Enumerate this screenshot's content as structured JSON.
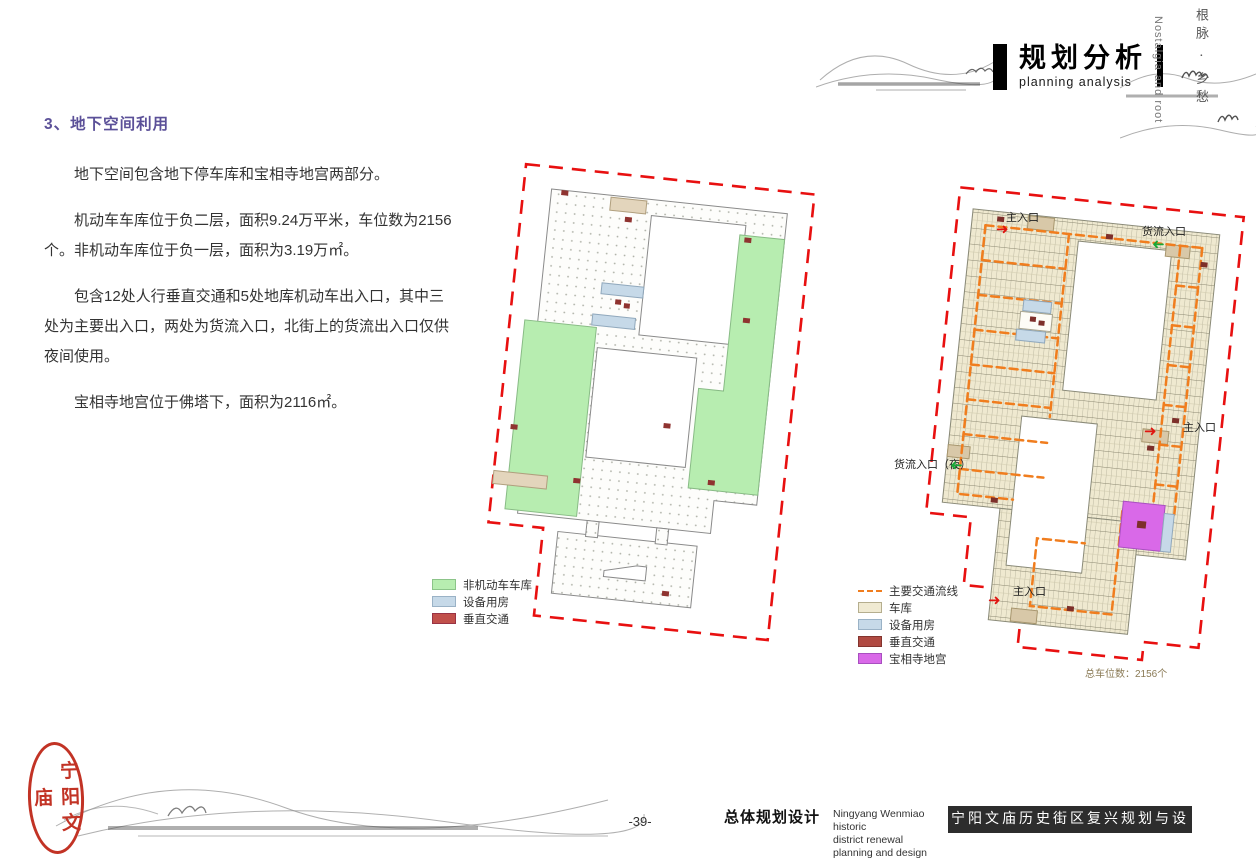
{
  "header": {
    "title_cn": "规划分析",
    "title_en": "planning analysis",
    "corner_cn": "根脉 · 乡愁",
    "corner_en": "Nostalgia and root"
  },
  "article": {
    "heading": "3、地下空间利用",
    "paragraphs": [
      "地下空间包含地下停车库和宝相寺地宫两部分。",
      "机动车车库位于负二层，面积9.24万平米，车位数为2156个。非机动车库位于负一层，面积为3.19万㎡。",
      "包含12处人行垂直交通和5处地库机动车出入口，其中三处为主要出入口，两处为货流入口，北街上的货流出入口仅供夜间使用。",
      "宝相寺地宫位于佛塔下，面积为2116㎡。"
    ]
  },
  "left_map": {
    "legend": [
      {
        "label": "非机动车车库",
        "color": "#b7edb0"
      },
      {
        "label": "设备用房",
        "color": "#c6d9e8"
      },
      {
        "label": "垂直交通",
        "color": "#c1504b"
      }
    ]
  },
  "right_map": {
    "labels": {
      "entrance_top": "主入口",
      "freight_top": "货流入口",
      "entrance_right": "主入口",
      "freight_left": "货流入口（夜）",
      "entrance_bottom": "主入口",
      "capacity_note": "总车位数：2156个"
    },
    "legend": [
      {
        "label": "主要交通流线",
        "color": "#f07d1e",
        "type": "dashed-line"
      },
      {
        "label": "车库",
        "color": "#f0ead2"
      },
      {
        "label": "设备用房",
        "color": "#c6d9e8"
      },
      {
        "label": "垂直交通",
        "color": "#b04a42"
      },
      {
        "label": "宝相寺地宫",
        "color": "#d969e8"
      }
    ]
  },
  "footer": {
    "page_number": "-39-",
    "doc_title_cn": "总体规划设计",
    "doc_title_en_line1": "Ningyang Wenmiao historic",
    "doc_title_en_line2": "district renewal planning and design",
    "banner": "宁阳文庙历史街区复兴规划与设计"
  },
  "seal": {
    "text": "宁阳文庙"
  },
  "colors": {
    "heading": "#5b5098",
    "boundary_red": "#e81010",
    "traffic_orange": "#f07d1e",
    "garage_cream": "#f0ead2",
    "nonmotor_green": "#b7edb0",
    "equipment_blue": "#c6d9e8",
    "vertical_red": "#b04a42",
    "palace_magenta": "#d969e8"
  }
}
